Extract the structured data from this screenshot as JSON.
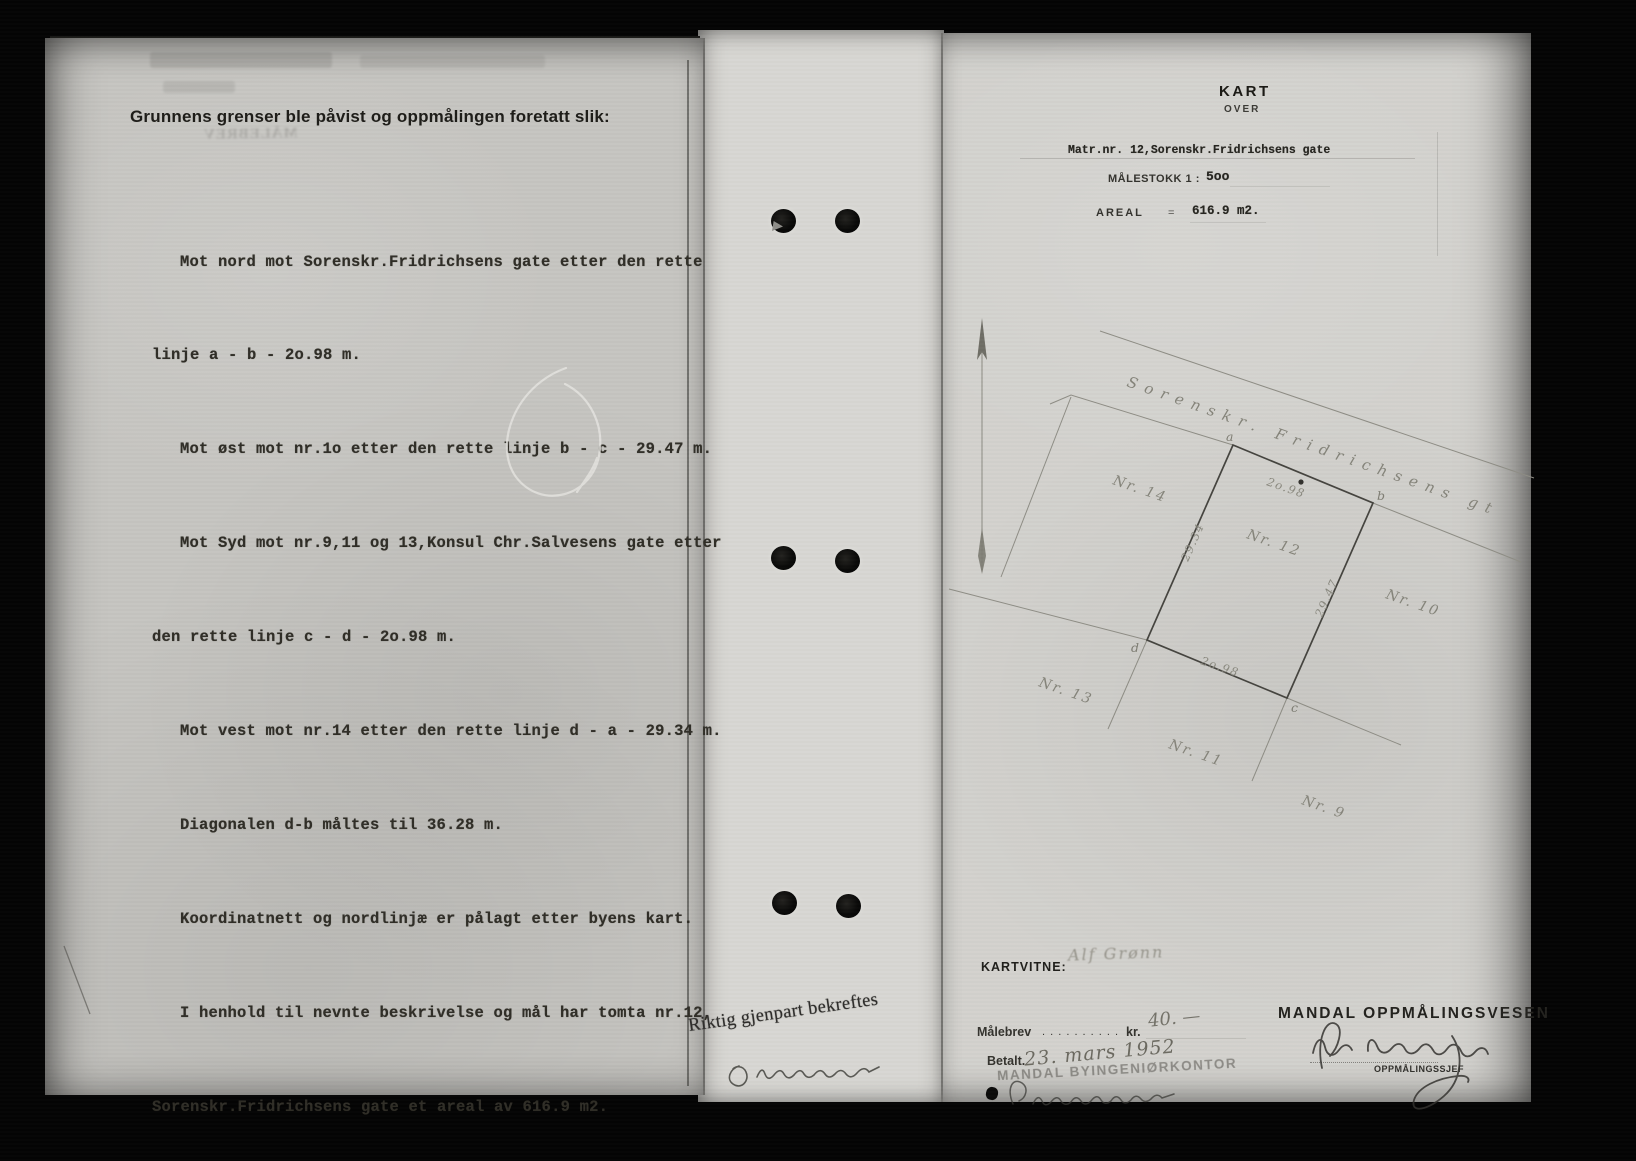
{
  "document_type": "scanned survey protocol page",
  "colors": {
    "scan_background": "#040404",
    "left_page": "#c6c5c1",
    "gutter_strip": "#d8d7d3",
    "right_page": "#d3d2ce",
    "typed_ink": "#302e27",
    "printed_ink": "#1d1c18",
    "pencil_drawing": "#8a897f"
  },
  "left_page": {
    "ghost_title": "MÅLEBREV",
    "heading": "Grunnens grenser ble påvist og oppmålingen foretatt slik:",
    "body": [
      {
        "text": "Mot nord mot Sorenskr.Fridrichsens gate etter den rette",
        "indent": true
      },
      {
        "text": "linje a - b - 2o.98 m.",
        "indent": false
      },
      {
        "text": "Mot øst mot nr.1o etter den rette linje b - c - 29.47 m.",
        "indent": true
      },
      {
        "text": "Mot Syd mot nr.9,11 og 13,Konsul Chr.Salvesens gate etter",
        "indent": true
      },
      {
        "text": "den rette linje c - d - 2o.98 m.",
        "indent": false
      },
      {
        "text": "Mot vest mot nr.14 etter den rette linje d - a - 29.34 m.",
        "indent": true
      },
      {
        "text": "Diagonalen d-b måltes til 36.28 m.",
        "indent": true
      },
      {
        "text": "Koordinatnett og nordlinjæ er pålagt etter byens kart.",
        "indent": true
      },
      {
        "text": "I henhold til nevnte beskrivelse og mål har tomta nr.12,",
        "indent": true
      },
      {
        "text": "Sorenskr.Fridrichsens gate et areal av 616.9 m2.",
        "indent": false
      }
    ]
  },
  "gutter": {
    "certify_stamp": "Riktig gjenpart bekreftes"
  },
  "right_page": {
    "title": "KART",
    "subtitle": "OVER",
    "matr_line": "Matr.nr. 12,Sorenskr.Fridrichsens gate",
    "scale_label": "MÅLESTOKK 1 :",
    "scale_value": "5oo",
    "areal_label": "AREAL",
    "areal_eq": "=",
    "areal_value": "616.9 m2.",
    "map": {
      "street_name": "Sorenskr. Fridrichsens gt",
      "plot_labels": [
        "Nr. 14",
        "Nr. 12",
        "Nr. 10",
        "Nr. 13",
        "Nr. 11",
        "Nr. 9"
      ],
      "corner_labels": [
        "a",
        "b",
        "c",
        "d"
      ],
      "measure_top": "2o.98",
      "measure_right": "29.47",
      "measure_bottom": "2o.98",
      "measure_left": "29.34"
    },
    "kartvitne_label": "KARTVITNE:",
    "kartvitne_name": "Alf Grønn",
    "fee_label": "Målebrev",
    "fee_leader": ". . . . . . . . . .",
    "fee_currency": "kr.",
    "fee_amount": "40. —",
    "paid_label": "Betalt.",
    "paid_date": "23. mars 1952",
    "office_stamp": "MANDAL BYINGENIØRKONTOR",
    "org_name": "MANDAL OPPMÅLINGSVESEN",
    "org_role": "OPPMÅLINGSSJEF"
  }
}
